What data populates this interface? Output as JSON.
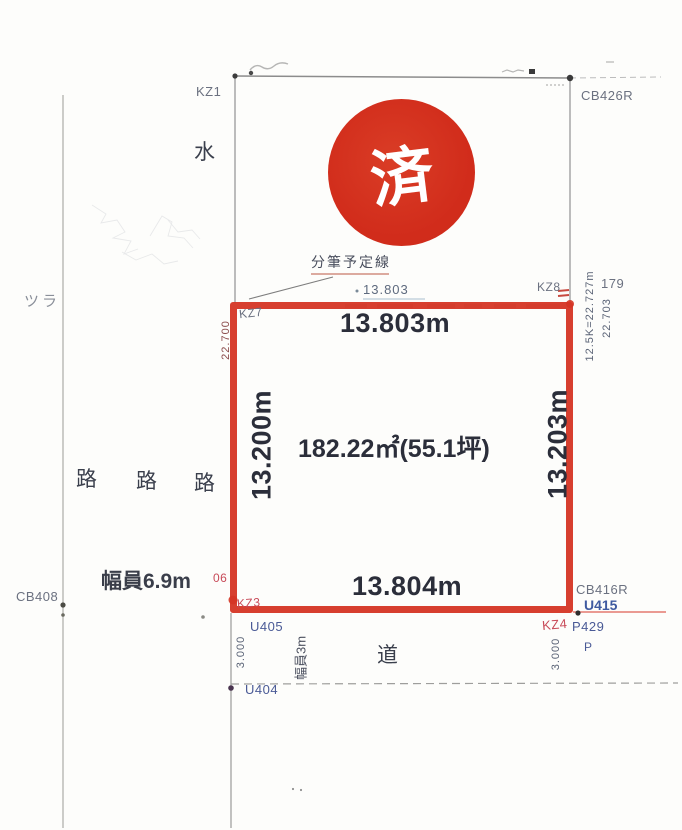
{
  "stamp": {
    "label": "済",
    "color": "#d12c1b"
  },
  "plot": {
    "area": "182.22㎡(55.1坪)",
    "top_length": "13.803m",
    "bottom_length": "13.804m",
    "left_length": "13.200m",
    "right_length": "13.203m",
    "outline_color": "#d53524"
  },
  "annotations": {
    "subdivision_label": "分筆予定線",
    "top_small_measure": "13.803",
    "left_outer_measure": "22.700",
    "right_outer_measure_a": "12.5K=22.727m",
    "right_outer_measure_b": "22.703",
    "lot_number": "179",
    "water": "水",
    "tsura": "ツラ",
    "ro": [
      "路",
      "路",
      "路"
    ],
    "road": "道",
    "road_width_main": "幅員6.9m",
    "road_width_side": "幅員3m",
    "side_len_left": "3.000",
    "side_len_right": "3.000",
    "mark_06": "06"
  },
  "survey_points": {
    "kz1": "KZ1",
    "kz7": "KZ7",
    "kz8": "KZ8",
    "kz3": "KZ3",
    "kz4": "KZ4",
    "cb426r": "CB426R",
    "cb408": "CB408",
    "cb416r": "CB416R",
    "u405": "U405",
    "u404": "U404",
    "u415": "U415",
    "p429": "P429",
    "p": "P"
  }
}
